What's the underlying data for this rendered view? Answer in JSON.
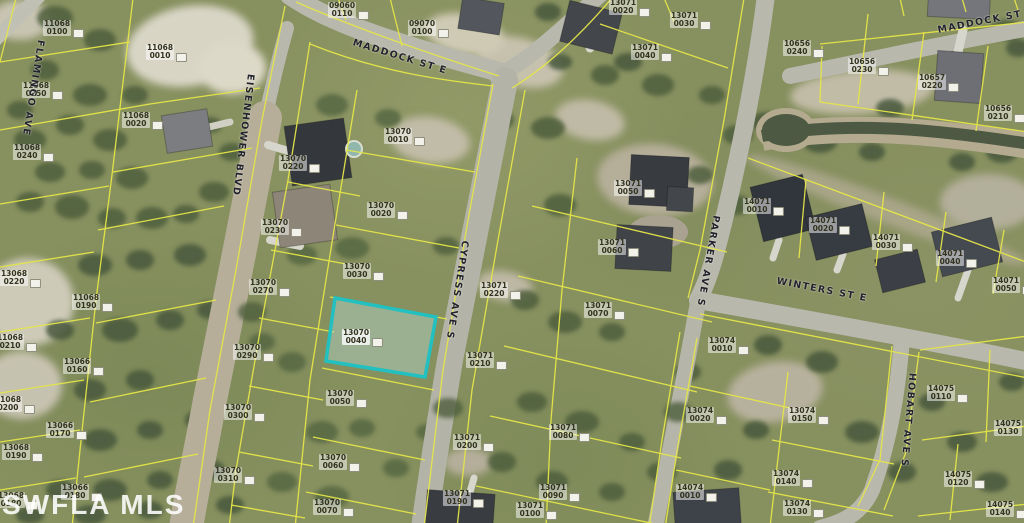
{
  "watermark": "SWFLA MLS",
  "colors": {
    "parcel_line": "#e6e73c",
    "highlight": "#17c3c3",
    "street_label": "#23232e",
    "road": "#b8b8ac",
    "dirt_road": "#b7ae97"
  },
  "highlighted_parcel": {
    "id": "13070 0040"
  },
  "streets": [
    {
      "name": "FLAMINGO AVE",
      "x": 33,
      "y": 88,
      "rotate": 99
    },
    {
      "name": "MADDOCK ST E",
      "x": 400,
      "y": 57,
      "rotate": 17
    },
    {
      "name": "MADDOCK ST E",
      "x": 986,
      "y": 21,
      "rotate": -11
    },
    {
      "name": "EISENHOWER BLVD",
      "x": 243,
      "y": 135,
      "rotate": 97
    },
    {
      "name": "CYPRESS AVE S",
      "x": 457,
      "y": 290,
      "rotate": 99
    },
    {
      "name": "PARKER AVE S",
      "x": 708,
      "y": 261,
      "rotate": 100
    },
    {
      "name": "WINTERS ST E",
      "x": 822,
      "y": 290,
      "rotate": 11
    },
    {
      "name": "HOBART AVE S",
      "x": 908,
      "y": 420,
      "rotate": 95
    }
  ],
  "parcels": [
    {
      "block": "11068",
      "lot": "0100",
      "x": 57,
      "y": 28
    },
    {
      "block": "11068",
      "lot": "0010",
      "x": 160,
      "y": 52
    },
    {
      "block": "11068",
      "lot": "0250",
      "x": 36,
      "y": 90
    },
    {
      "block": "11068",
      "lot": "0020",
      "x": 136,
      "y": 120
    },
    {
      "block": "11068",
      "lot": "0240",
      "x": 27,
      "y": 152
    },
    {
      "block": "13068",
      "lot": "0220",
      "x": 14,
      "y": 278
    },
    {
      "block": "11068",
      "lot": "0190",
      "x": 86,
      "y": 302
    },
    {
      "block": "11068",
      "lot": "0210",
      "x": 10,
      "y": 342
    },
    {
      "block": "13066",
      "lot": "0160",
      "x": 77,
      "y": 366
    },
    {
      "block": "11068",
      "lot": "0200",
      "x": 8,
      "y": 404
    },
    {
      "block": "13066",
      "lot": "0170",
      "x": 60,
      "y": 430
    },
    {
      "block": "13068",
      "lot": "0190",
      "x": 16,
      "y": 452
    },
    {
      "block": "13066",
      "lot": "0180",
      "x": 75,
      "y": 492
    },
    {
      "block": "13068",
      "lot": "0180",
      "x": 11,
      "y": 500
    },
    {
      "block": "09060",
      "lot": "0110",
      "x": 342,
      "y": 10
    },
    {
      "block": "09070",
      "lot": "0100",
      "x": 422,
      "y": 28
    },
    {
      "block": "13070",
      "lot": "0220",
      "x": 293,
      "y": 163
    },
    {
      "block": "13070",
      "lot": "0230",
      "x": 275,
      "y": 227
    },
    {
      "block": "13070",
      "lot": "0270",
      "x": 263,
      "y": 287
    },
    {
      "block": "13070",
      "lot": "0290",
      "x": 247,
      "y": 352
    },
    {
      "block": "13070",
      "lot": "0300",
      "x": 238,
      "y": 412
    },
    {
      "block": "13070",
      "lot": "0310",
      "x": 228,
      "y": 475
    },
    {
      "block": "13070",
      "lot": "0010",
      "x": 398,
      "y": 136
    },
    {
      "block": "13070",
      "lot": "0020",
      "x": 381,
      "y": 210
    },
    {
      "block": "13070",
      "lot": "0030",
      "x": 357,
      "y": 271
    },
    {
      "block": "13070",
      "lot": "0040",
      "x": 356,
      "y": 337,
      "highlight": true
    },
    {
      "block": "13070",
      "lot": "0050",
      "x": 340,
      "y": 398
    },
    {
      "block": "13070",
      "lot": "0060",
      "x": 333,
      "y": 462
    },
    {
      "block": "13070",
      "lot": "0070",
      "x": 327,
      "y": 507
    },
    {
      "block": "13071",
      "lot": "0020",
      "x": 623,
      "y": 7
    },
    {
      "block": "13071",
      "lot": "0030",
      "x": 684,
      "y": 20
    },
    {
      "block": "13071",
      "lot": "0040",
      "x": 645,
      "y": 52
    },
    {
      "block": "13071",
      "lot": "0050",
      "x": 628,
      "y": 188
    },
    {
      "block": "13071",
      "lot": "0060",
      "x": 612,
      "y": 247
    },
    {
      "block": "13071",
      "lot": "0070",
      "x": 598,
      "y": 310
    },
    {
      "block": "13071",
      "lot": "0220",
      "x": 494,
      "y": 290
    },
    {
      "block": "13071",
      "lot": "0210",
      "x": 480,
      "y": 360
    },
    {
      "block": "13071",
      "lot": "0200",
      "x": 467,
      "y": 442
    },
    {
      "block": "13071",
      "lot": "0190",
      "x": 457,
      "y": 498
    },
    {
      "block": "13071",
      "lot": "0080",
      "x": 563,
      "y": 432
    },
    {
      "block": "13071",
      "lot": "0090",
      "x": 553,
      "y": 492
    },
    {
      "block": "13071",
      "lot": "0100",
      "x": 530,
      "y": 510
    },
    {
      "block": "14071",
      "lot": "0010",
      "x": 757,
      "y": 206
    },
    {
      "block": "14071",
      "lot": "0020",
      "x": 823,
      "y": 225
    },
    {
      "block": "14071",
      "lot": "0030",
      "x": 886,
      "y": 242
    },
    {
      "block": "14071",
      "lot": "0040",
      "x": 950,
      "y": 258
    },
    {
      "block": "14071",
      "lot": "0050",
      "x": 1006,
      "y": 285
    },
    {
      "block": "10656",
      "lot": "0240",
      "x": 797,
      "y": 48
    },
    {
      "block": "10656",
      "lot": "0230",
      "x": 862,
      "y": 66
    },
    {
      "block": "10657",
      "lot": "0220",
      "x": 932,
      "y": 82
    },
    {
      "block": "10656",
      "lot": "0210",
      "x": 998,
      "y": 113
    },
    {
      "block": "13074",
      "lot": "0010",
      "x": 722,
      "y": 345
    },
    {
      "block": "13074",
      "lot": "0020",
      "x": 700,
      "y": 415
    },
    {
      "block": "13074",
      "lot": "0150",
      "x": 802,
      "y": 415
    },
    {
      "block": "13074",
      "lot": "0140",
      "x": 786,
      "y": 478
    },
    {
      "block": "13074",
      "lot": "0130",
      "x": 797,
      "y": 508
    },
    {
      "block": "14074",
      "lot": "0010",
      "x": 690,
      "y": 492
    },
    {
      "block": "14075",
      "lot": "0110",
      "x": 941,
      "y": 393
    },
    {
      "block": "14075",
      "lot": "0130",
      "x": 1008,
      "y": 428
    },
    {
      "block": "14075",
      "lot": "0120",
      "x": 958,
      "y": 479
    },
    {
      "block": "14075",
      "lot": "0140",
      "x": 1000,
      "y": 509
    }
  ]
}
